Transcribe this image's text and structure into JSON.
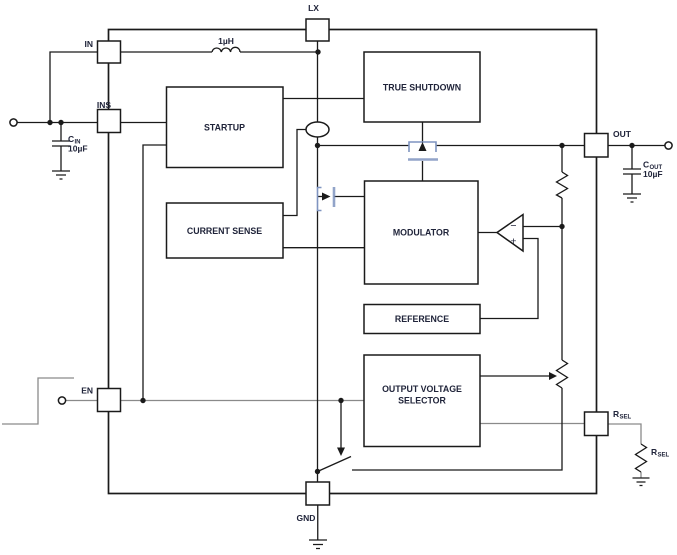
{
  "colors": {
    "background": "#ffffff",
    "wire": "#1a1a1a",
    "wire_gray": "#8a8a8a",
    "mosfet_blue": "#7f94c0",
    "text": "#20243a"
  },
  "pins": {
    "in": {
      "label": "IN"
    },
    "ins": {
      "label": "INS"
    },
    "lx": {
      "label": "LX"
    },
    "out": {
      "label": "OUT"
    },
    "en": {
      "label": "EN"
    },
    "gnd": {
      "label": "GND"
    },
    "rsel": {
      "label_main": "R",
      "label_sub": "SEL"
    }
  },
  "blocks": {
    "startup": {
      "label": "STARTUP"
    },
    "current_sense": {
      "label": "CURRENT SENSE"
    },
    "true_shutdown": {
      "label": "TRUE SHUTDOWN"
    },
    "modulator": {
      "label": "MODULATOR"
    },
    "reference": {
      "label": "REFERENCE"
    },
    "output_voltage_selector": {
      "label_line1": "OUTPUT VOLTAGE",
      "label_line2": "SELECTOR"
    }
  },
  "components": {
    "inductor": {
      "label": "1µH"
    },
    "input_capacitor": {
      "label_main": "C",
      "label_sub": "IN",
      "value": "10µF"
    },
    "output_capacitor": {
      "label_main": "C",
      "label_sub": "OUT",
      "value": "10µF"
    },
    "rsel_resistor": {
      "label_main": "R",
      "label_sub": "SEL"
    }
  },
  "comparator": {
    "minus_label": "−",
    "plus_label": "+"
  }
}
